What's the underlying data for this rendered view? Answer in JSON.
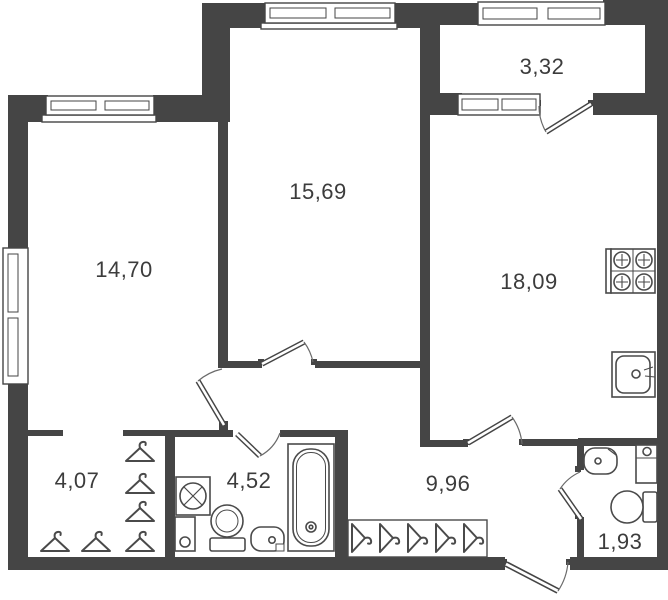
{
  "plan": {
    "rooms": [
      {
        "id": "room-14-70",
        "area": "14,70"
      },
      {
        "id": "room-15-69",
        "area": "15,69"
      },
      {
        "id": "balcony",
        "area": "3,32"
      },
      {
        "id": "kitchen",
        "area": "18,09"
      },
      {
        "id": "closet",
        "area": "4,07"
      },
      {
        "id": "bathroom",
        "area": "4,52"
      },
      {
        "id": "hallway",
        "area": "9,96"
      },
      {
        "id": "wc",
        "area": "1,93"
      }
    ],
    "colors": {
      "wall": "#454545",
      "fixture_line": "#4a4a4a",
      "text": "#3c3c3c",
      "background": "#ffffff"
    },
    "fixtures": [
      "window",
      "door",
      "bathtub",
      "toilet",
      "washbasin",
      "kitchen-sink",
      "stove",
      "washing-machine",
      "clothes-hangers",
      "wardrobe",
      "entrance-door"
    ]
  }
}
